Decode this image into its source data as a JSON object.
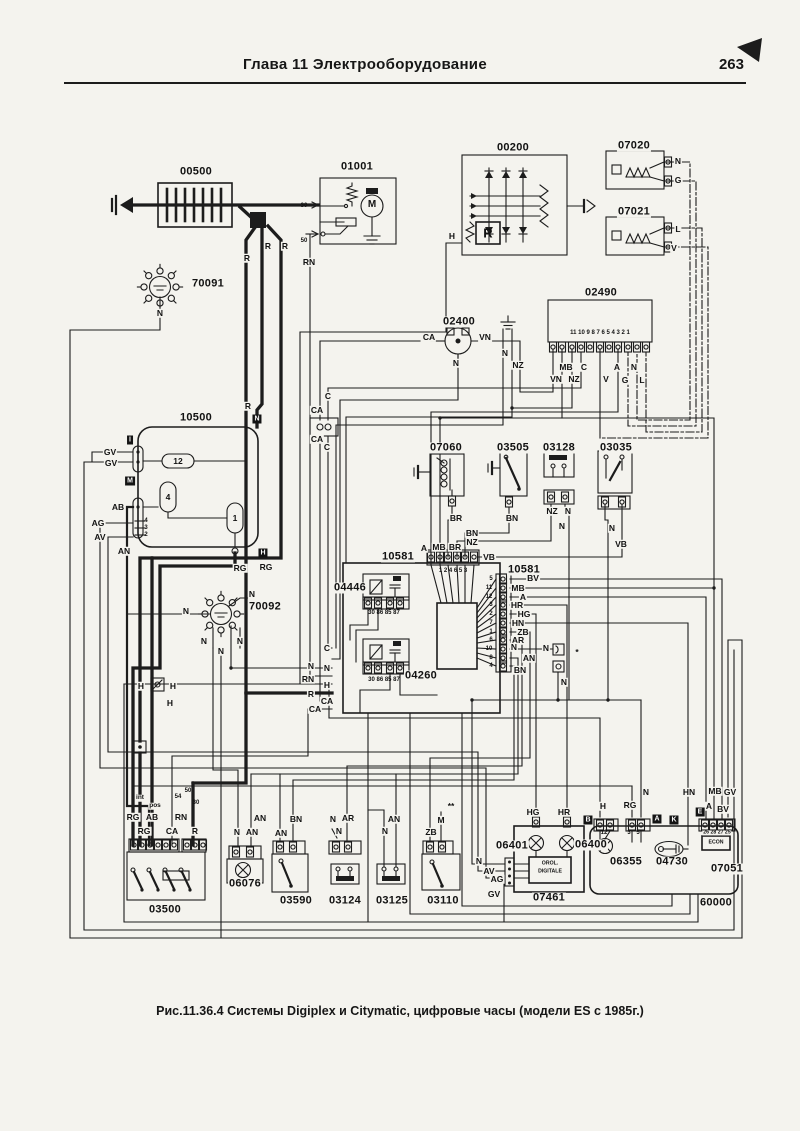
{
  "page": {
    "header": "Глава 11  Электрооборудование",
    "page_number": "263",
    "caption": "Рис.11.36.4 Системы Digiplex и Citymatic, цифровые часы (модели ES с 1985г.)"
  },
  "labels": [
    [
      "00500",
      196,
      172,
      "id"
    ],
    [
      "01001",
      357,
      167,
      "id"
    ],
    [
      "00200",
      513,
      148,
      "id"
    ],
    [
      "07020",
      634,
      146,
      "id"
    ],
    [
      "07021",
      634,
      212,
      "id"
    ],
    [
      "70091",
      208,
      284,
      "id"
    ],
    [
      "02400",
      459,
      322,
      "id"
    ],
    [
      "02490",
      601,
      293,
      "id"
    ],
    [
      "10500",
      196,
      418,
      "id"
    ],
    [
      "07060",
      446,
      448,
      "id"
    ],
    [
      "03505",
      513,
      448,
      "id"
    ],
    [
      "03128",
      559,
      448,
      "id"
    ],
    [
      "03035",
      616,
      448,
      "id"
    ],
    [
      "10581",
      398,
      557,
      "id"
    ],
    [
      "10581",
      524,
      570,
      "id"
    ],
    [
      "04446",
      350,
      588,
      "id"
    ],
    [
      "04260",
      421,
      676,
      "id"
    ],
    [
      "70092",
      265,
      607,
      "id"
    ],
    [
      "03500",
      165,
      910,
      "id"
    ],
    [
      "06076",
      245,
      884,
      "id"
    ],
    [
      "03590",
      296,
      901,
      "id"
    ],
    [
      "03124",
      345,
      901,
      "id"
    ],
    [
      "03125",
      392,
      901,
      "id"
    ],
    [
      "03110",
      443,
      901,
      "id"
    ],
    [
      "06401",
      512,
      846,
      "id"
    ],
    [
      "06400",
      591,
      845,
      "id"
    ],
    [
      "06355",
      626,
      862,
      "id"
    ],
    [
      "04730",
      672,
      862,
      "id"
    ],
    [
      "07051",
      727,
      869,
      "id"
    ],
    [
      "07461",
      549,
      898,
      "id"
    ],
    [
      "60000",
      716,
      903,
      "id"
    ],
    [
      "R",
      247,
      258
    ],
    [
      "R",
      268,
      246
    ],
    [
      "R",
      285,
      246
    ],
    [
      "30",
      304,
      206,
      "pn"
    ],
    [
      "50",
      304,
      241,
      "pn"
    ],
    [
      "RN",
      309,
      262
    ],
    [
      "N",
      160,
      313
    ],
    [
      "H",
      452,
      236
    ],
    [
      "N",
      678,
      161
    ],
    [
      "G",
      678,
      180
    ],
    [
      "L",
      678,
      229
    ],
    [
      "V",
      674,
      248
    ],
    [
      "CA",
      429,
      337
    ],
    [
      "VN",
      485,
      337
    ],
    [
      "N",
      456,
      363
    ],
    [
      "N",
      505,
      353
    ],
    [
      "NZ",
      518,
      365
    ],
    [
      "11 10 9 8 7 6 5 4 3 2 1",
      600,
      333,
      "pn"
    ],
    [
      "MB",
      566,
      367
    ],
    [
      "C",
      584,
      367
    ],
    [
      "A",
      617,
      367
    ],
    [
      "N",
      634,
      367
    ],
    [
      "VN",
      556,
      379
    ],
    [
      "NZ",
      574,
      379
    ],
    [
      "V",
      606,
      379
    ],
    [
      "G",
      625,
      380
    ],
    [
      "L",
      642,
      380
    ],
    [
      "R",
      248,
      406
    ],
    [
      "GV",
      110,
      452
    ],
    [
      "GV",
      111,
      463
    ],
    [
      "AB",
      118,
      507
    ],
    [
      "AG",
      98,
      523
    ],
    [
      "AV",
      100,
      537
    ],
    [
      "AN",
      124,
      551
    ],
    [
      "4",
      146,
      521,
      "pn"
    ],
    [
      "3",
      146,
      528,
      "pn"
    ],
    [
      "2",
      146,
      535,
      "pn"
    ],
    [
      "12",
      178,
      461
    ],
    [
      "4",
      168,
      497
    ],
    [
      "1",
      235,
      518
    ],
    [
      "RG",
      240,
      568
    ],
    [
      "RG",
      266,
      567
    ],
    [
      "BR",
      456,
      518
    ],
    [
      "BN",
      512,
      518
    ],
    [
      "NZ",
      552,
      511
    ],
    [
      "N",
      568,
      511
    ],
    [
      "N",
      562,
      526
    ],
    [
      "N",
      612,
      528
    ],
    [
      "VB",
      621,
      544
    ],
    [
      "BN",
      472,
      533
    ],
    [
      "NZ",
      472,
      542
    ],
    [
      "A",
      424,
      548
    ],
    [
      "MB",
      439,
      547
    ],
    [
      "BR",
      455,
      547
    ],
    [
      "VB",
      489,
      557
    ],
    [
      "1 2 4 6 5 3",
      453,
      571,
      "pn"
    ],
    [
      "30 86 85 87",
      384,
      613,
      "pn"
    ],
    [
      "30 86 85 87",
      384,
      680,
      "pn"
    ],
    [
      "5",
      491,
      579,
      "pn"
    ],
    [
      "11",
      489,
      588,
      "pn"
    ],
    [
      "12",
      489,
      597,
      "pn"
    ],
    [
      "3",
      491,
      605,
      "pn"
    ],
    [
      "2",
      491,
      614,
      "pn"
    ],
    [
      "7",
      491,
      623,
      "pn"
    ],
    [
      "1",
      491,
      632,
      "pn"
    ],
    [
      "6",
      491,
      640,
      "pn"
    ],
    [
      "10",
      489,
      649,
      "pn"
    ],
    [
      "8",
      491,
      658,
      "pn"
    ],
    [
      "4",
      491,
      666,
      "pn"
    ],
    [
      "BV",
      533,
      578
    ],
    [
      "MB",
      518,
      588
    ],
    [
      "A",
      523,
      597
    ],
    [
      "HR",
      517,
      605
    ],
    [
      "HG",
      524,
      614
    ],
    [
      "HN",
      518,
      623
    ],
    [
      "ZB",
      523,
      632
    ],
    [
      "AR",
      518,
      640
    ],
    [
      "N",
      514,
      647
    ],
    [
      "AN",
      529,
      658
    ],
    [
      "BN",
      520,
      670
    ],
    [
      "N",
      546,
      648
    ],
    [
      "*",
      577,
      652
    ],
    [
      "N",
      564,
      682
    ],
    [
      "C",
      327,
      648
    ],
    [
      "N",
      311,
      666
    ],
    [
      "N",
      327,
      668
    ],
    [
      "RN",
      308,
      679
    ],
    [
      "H",
      327,
      685
    ],
    [
      "R",
      311,
      694
    ],
    [
      "CA",
      327,
      701
    ],
    [
      "CA",
      315,
      709
    ],
    [
      "C",
      328,
      396
    ],
    [
      "CA",
      317,
      410
    ],
    [
      "CA",
      317,
      439
    ],
    [
      "C",
      327,
      447
    ],
    [
      "N",
      186,
      611
    ],
    [
      "N",
      252,
      594
    ],
    [
      "N",
      204,
      641
    ],
    [
      "N",
      221,
      651
    ],
    [
      "N",
      240,
      641
    ],
    [
      "H",
      141,
      686
    ],
    [
      "H",
      173,
      686
    ],
    [
      "H",
      170,
      703
    ],
    [
      "int",
      140,
      798,
      "intl"
    ],
    [
      "pos",
      155,
      806,
      "intl"
    ],
    [
      "50",
      188,
      791,
      "pn"
    ],
    [
      "54",
      178,
      797,
      "pn"
    ],
    [
      "30",
      196,
      803,
      "pn"
    ],
    [
      "RG",
      133,
      817
    ],
    [
      "AB",
      152,
      817
    ],
    [
      "RN",
      181,
      817
    ],
    [
      "RG",
      144,
      831
    ],
    [
      "CA",
      172,
      831
    ],
    [
      "R",
      195,
      831
    ],
    [
      "AN",
      260,
      818
    ],
    [
      "N",
      237,
      832
    ],
    [
      "AN",
      252,
      832
    ],
    [
      "BN",
      296,
      819
    ],
    [
      "AN",
      281,
      833
    ],
    [
      "N",
      333,
      819
    ],
    [
      "AR",
      348,
      818
    ],
    [
      "N",
      339,
      831
    ],
    [
      "AN",
      394,
      819
    ],
    [
      "N",
      385,
      831
    ],
    [
      "**",
      451,
      806
    ],
    [
      "M",
      441,
      820
    ],
    [
      "ZB",
      431,
      832
    ],
    [
      "N",
      479,
      861
    ],
    [
      "HG",
      533,
      812
    ],
    [
      "HR",
      564,
      812
    ],
    [
      "H",
      603,
      806
    ],
    [
      "RG",
      630,
      805
    ],
    [
      "N",
      646,
      792
    ],
    [
      "HN",
      689,
      792
    ],
    [
      "MB",
      715,
      791
    ],
    [
      "GV",
      730,
      792
    ],
    [
      "A",
      709,
      806
    ],
    [
      "BV",
      723,
      809
    ],
    [
      "12",
      604,
      833,
      "pn"
    ],
    [
      "3",
      629,
      833,
      "pn"
    ],
    [
      "5",
      638,
      833,
      "pn"
    ],
    [
      "26 28 27 25",
      717,
      833,
      "tiny"
    ],
    [
      "AV",
      489,
      871
    ],
    [
      "AG",
      497,
      879
    ],
    [
      "GV",
      494,
      894
    ],
    [
      "OROL.",
      550,
      864,
      "tiny"
    ],
    [
      "DIGITALE",
      550,
      872,
      "tiny"
    ],
    [
      "ECON",
      716,
      843,
      "tiny"
    ],
    [
      "M",
      372,
      205,
      "mc"
    ],
    [
      "R",
      488,
      233,
      "rb"
    ],
    [
      "I",
      130,
      440,
      "inv"
    ],
    [
      "M",
      130,
      481,
      "inv"
    ],
    [
      "N",
      257,
      419,
      "inv"
    ],
    [
      "H",
      263,
      553,
      "inv"
    ],
    [
      "B",
      588,
      820,
      "inv"
    ],
    [
      "A",
      657,
      819,
      "inv"
    ],
    [
      "K",
      674,
      820,
      "inv"
    ],
    [
      "E",
      700,
      812,
      "inv"
    ]
  ]
}
